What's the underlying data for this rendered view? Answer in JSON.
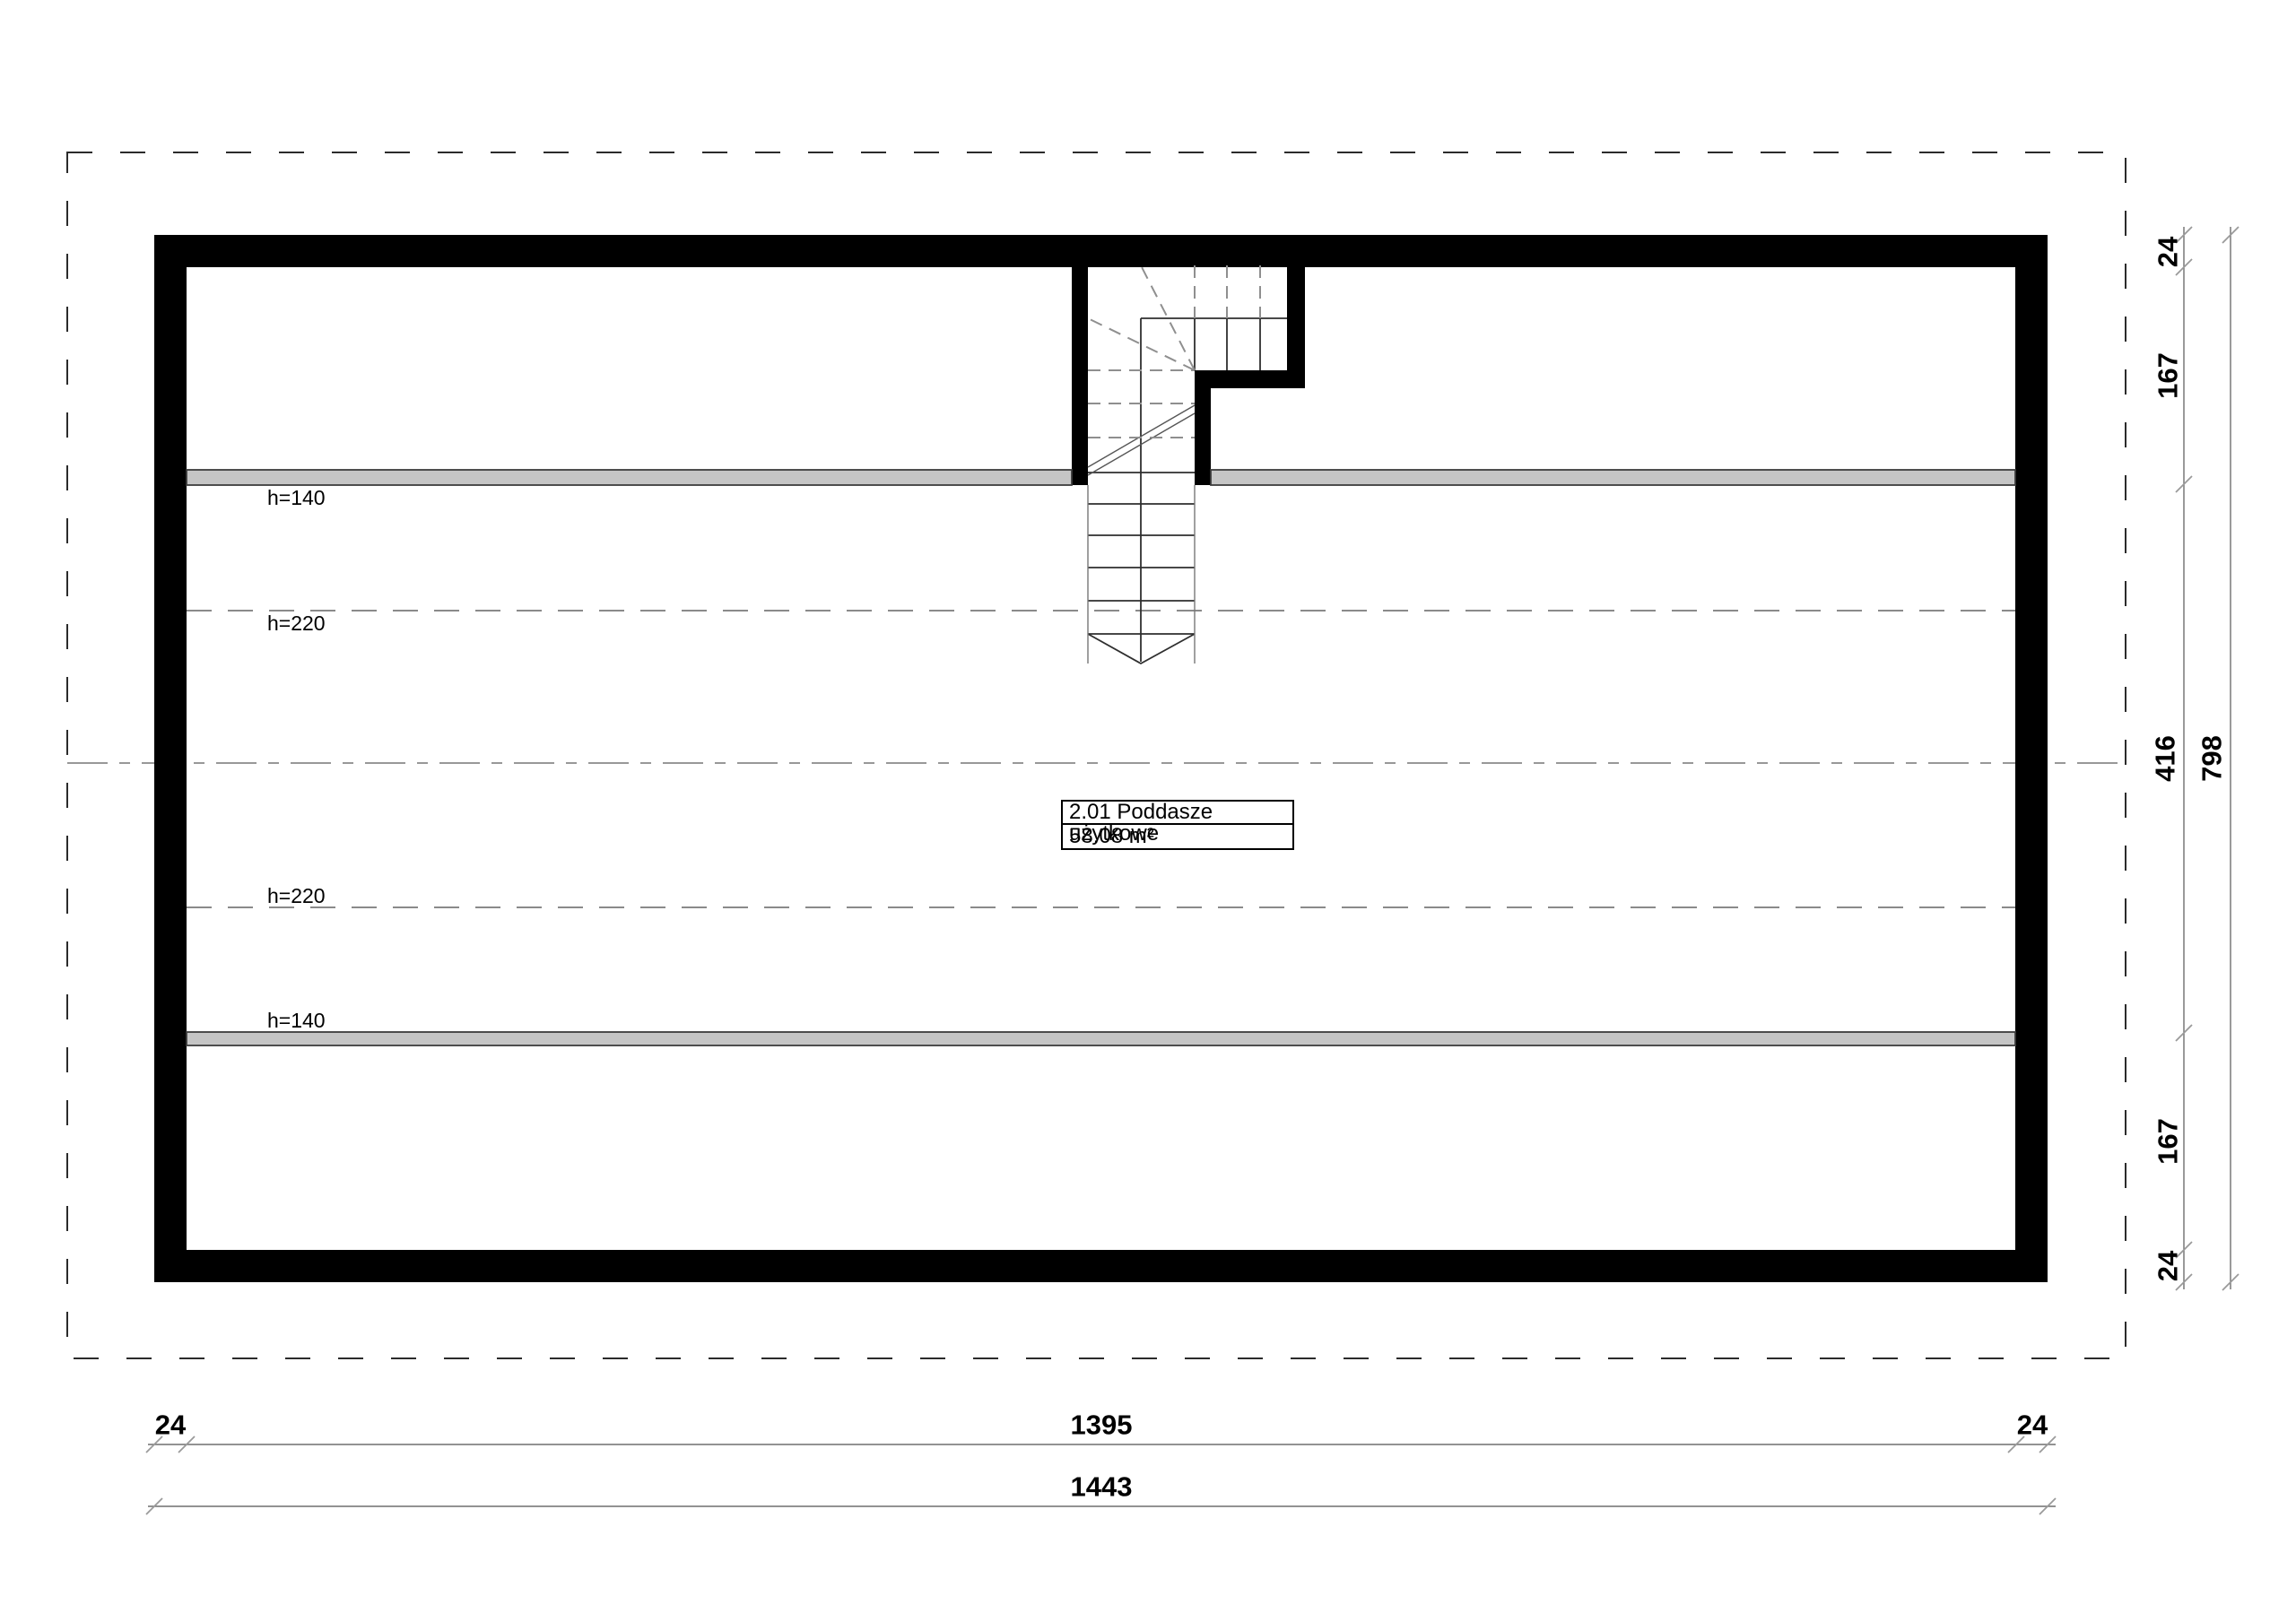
{
  "title": "Attic floor plan",
  "room_label": {
    "name": "2.01 Poddasze użytkowe",
    "area": "58.08 m²"
  },
  "height_labels": {
    "top_h140": "h=140",
    "top_h220": "h=220",
    "bottom_h220": "h=220",
    "bottom_h140": "h=140"
  },
  "dimensions": {
    "right_inner": {
      "seg1": "24",
      "seg2": "167",
      "seg3": "416",
      "seg4": "167",
      "seg5": "24"
    },
    "right_total": "798",
    "bottom_inner": {
      "seg1": "24",
      "seg2": "1395",
      "seg3": "24"
    },
    "bottom_total": "1443"
  },
  "colors": {
    "wall": "#000000",
    "knee_wall": "#c5c5c5",
    "background": "#ffffff",
    "dashed_line": "#8a8a8a",
    "dimension_line": "#6f6f6f"
  }
}
